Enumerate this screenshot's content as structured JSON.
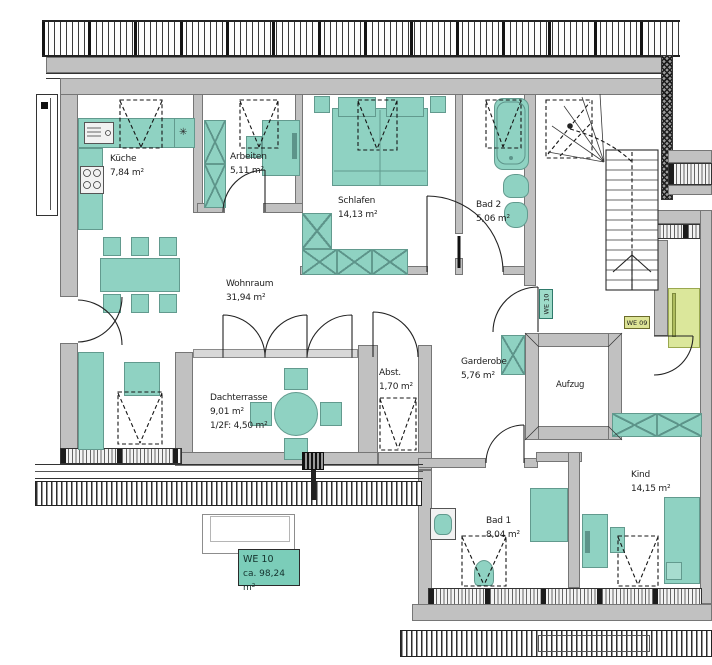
{
  "plan": {
    "unit_label": {
      "line1": "WE 10",
      "line2": "ca. 98,24 m²"
    },
    "tags": {
      "we10": "WE 10",
      "we09": "WE 09"
    },
    "icons": {
      "radiator": "✳"
    },
    "rooms": [
      {
        "id": "kueche",
        "name": "Küche",
        "area": "7,84 m²"
      },
      {
        "id": "arbeiten",
        "name": "Arbeiten",
        "area": "5,11 m²"
      },
      {
        "id": "schlafen",
        "name": "Schlafen",
        "area": "14,13 m²"
      },
      {
        "id": "bad2",
        "name": "Bad 2",
        "area": "5,06 m²"
      },
      {
        "id": "wohnraum",
        "name": "Wohnraum",
        "area": "31,94 m²"
      },
      {
        "id": "dachterrasse",
        "name": "Dachterrasse",
        "area": "9,01 m²",
        "area2": "1/2F: 4,50 m²"
      },
      {
        "id": "abstellraum",
        "name": "Abst.",
        "area": "1,70 m²"
      },
      {
        "id": "garderobe",
        "name": "Garderobe",
        "area": "5,76 m²"
      },
      {
        "id": "aufzug",
        "name": "Aufzug",
        "area": ""
      },
      {
        "id": "bad1",
        "name": "Bad 1",
        "area": "8,04 m²"
      },
      {
        "id": "kind",
        "name": "Kind",
        "area": "14,15 m²"
      }
    ],
    "colors": {
      "furniture": "#8fd2c2",
      "wall": "#c1c1c1",
      "we09_accent": "#dbe79b",
      "unit_box": "#7bcdb9"
    }
  }
}
